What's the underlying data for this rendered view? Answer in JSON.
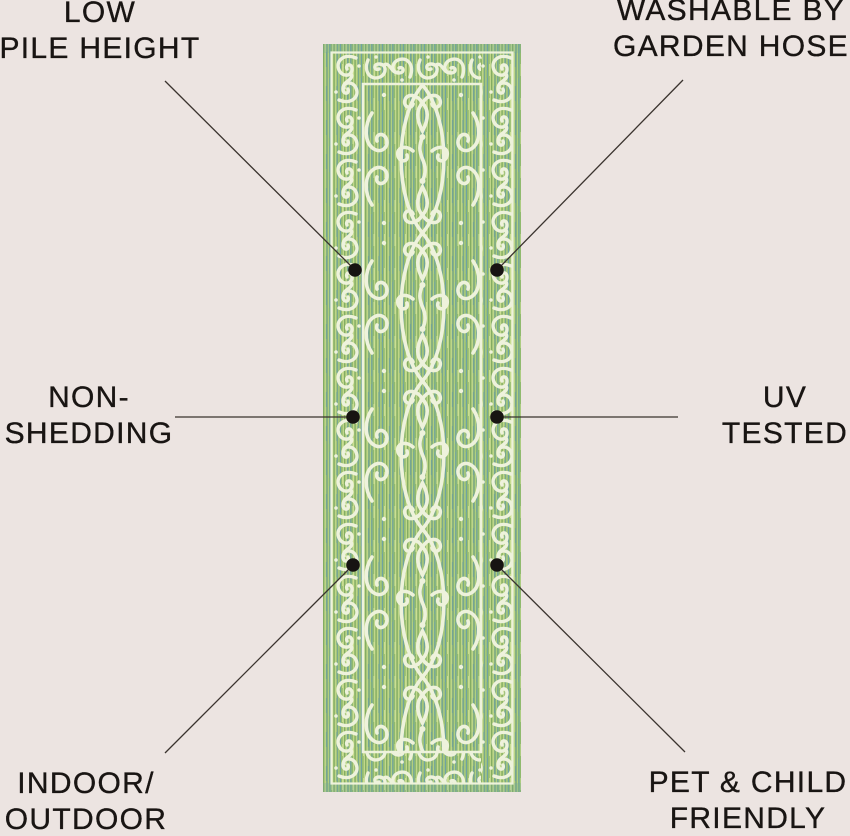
{
  "page": {
    "background_color": "#ece4e1",
    "text_color": "#191513"
  },
  "rug": {
    "name": "green-ornate-scroll-runner-rug",
    "colors": {
      "green_base": "#9cbe72",
      "green_light": "#c6dc8c",
      "green_teal": "#6aa0a5",
      "pattern_cream": "#eef2dc"
    }
  },
  "connector": {
    "line_color": "#3a332e",
    "dot_color": "#171412"
  },
  "callouts": [
    {
      "id": "low-pile-height",
      "position": "top-left",
      "lines": [
        "LOW",
        "PILE HEIGHT"
      ]
    },
    {
      "id": "washable-by-garden-hose",
      "position": "top-right",
      "lines": [
        "WASHABLE BY",
        "GARDEN HOSE"
      ]
    },
    {
      "id": "non-shedding",
      "position": "middle-left",
      "lines": [
        "NON-",
        "SHEDDING"
      ]
    },
    {
      "id": "uv-tested",
      "position": "middle-right",
      "lines": [
        "UV",
        "TESTED"
      ]
    },
    {
      "id": "indoor-outdoor",
      "position": "bottom-left",
      "lines": [
        "INDOOR/",
        "OUTDOOR"
      ]
    },
    {
      "id": "pet-child-friendly",
      "position": "bottom-right",
      "lines": [
        "PET & CHILD",
        "FRIENDLY"
      ]
    }
  ]
}
